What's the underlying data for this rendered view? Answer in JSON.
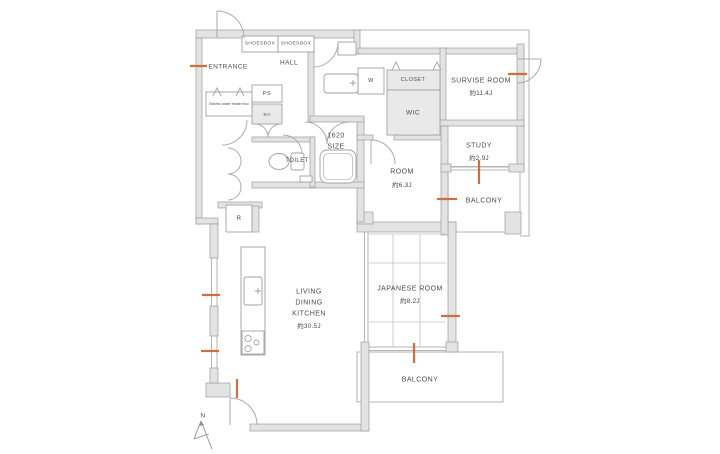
{
  "colors": {
    "wall_fill": "#e3e3e3",
    "wall_stroke": "#9b9b9b",
    "thin_line": "#b5b5b5",
    "arc_line": "#ababab",
    "text": "#4b4b4b",
    "marker_orange": "#d06f3e",
    "background": "#ffffff"
  },
  "compass": {
    "label": "N"
  },
  "rooms": {
    "entrance": {
      "label": "ENTRANCE"
    },
    "hall": {
      "label": "HALL"
    },
    "shoesbox_left": {
      "label": "SHOESBOX"
    },
    "shoesbox_right": {
      "label": "SHOESBOX"
    },
    "electric_water_heater_box": {
      "label": "Electric water heater box"
    },
    "ps": {
      "label": "PS"
    },
    "meter_box": {
      "label": "Box"
    },
    "washer_space": {
      "label": "W"
    },
    "closet": {
      "label": "CLOSET"
    },
    "wic": {
      "label": "WIC"
    },
    "survise_room": {
      "label": "SURVISE ROOM",
      "area": "約11.4J"
    },
    "study": {
      "label": "STUDY",
      "area": "約2.9J"
    },
    "room": {
      "label": "ROOM",
      "area": "約6.3J"
    },
    "toilet": {
      "label": "TOILET"
    },
    "bathroom": {
      "size_line1": "1620",
      "size_line2": "SIZE"
    },
    "living_dining_kitchen": {
      "line1": "LIVING",
      "line2": "DINING",
      "line3": "KITCHEN",
      "area": "約30.5J"
    },
    "japanese_room": {
      "label": "JAPANESE ROOM",
      "area": "約8.2J"
    },
    "balcony_right": {
      "label": "BALCONY"
    },
    "balcony_bottom": {
      "label": "BALCONY"
    },
    "refrigerator": {
      "label": "R"
    }
  }
}
